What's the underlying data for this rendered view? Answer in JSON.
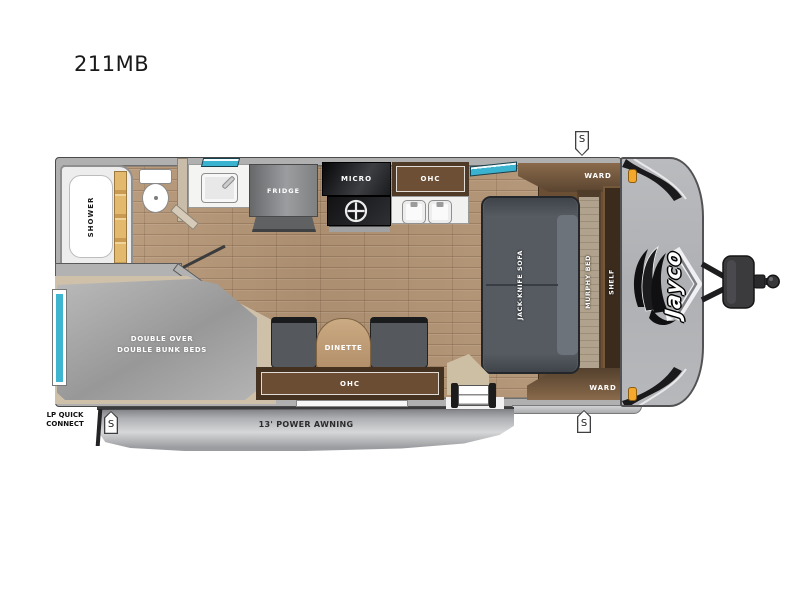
{
  "title": "211MB",
  "floorplan": {
    "brand_logo": "Jayco",
    "speaker_symbol": "S",
    "labels": {
      "shower": "SHOWER",
      "fridge": "FRIDGE",
      "micro": "MICRO",
      "ohc": "OHC",
      "ward": "WARD",
      "sofa": "JACK-KNIFE SOFA",
      "murphy_bed": "MURPHY BED",
      "shelf": "SHELF",
      "dinette": "DINETTE",
      "bunks_line1": "DOUBLE OVER",
      "bunks_line2": "DOUBLE BUNK BEDS",
      "awning": "13' POWER AWNING",
      "lp_line1": "LP QUICK",
      "lp_line2": "CONNECT"
    },
    "colors": {
      "floor_wood": "#b6987a",
      "wall_gray": "#b2b2b2",
      "cabinet_brown": "#6b4d33",
      "dark_wood": "#44311f",
      "sofa_gray": "#565b61",
      "mattress_gray": "#a9a9a9",
      "window_teal": "#3eb6d2",
      "shower_door_gold": "#d8a85f",
      "cap_gray": "#b5b7ba",
      "marker_light_orange": "#f5a623"
    }
  }
}
